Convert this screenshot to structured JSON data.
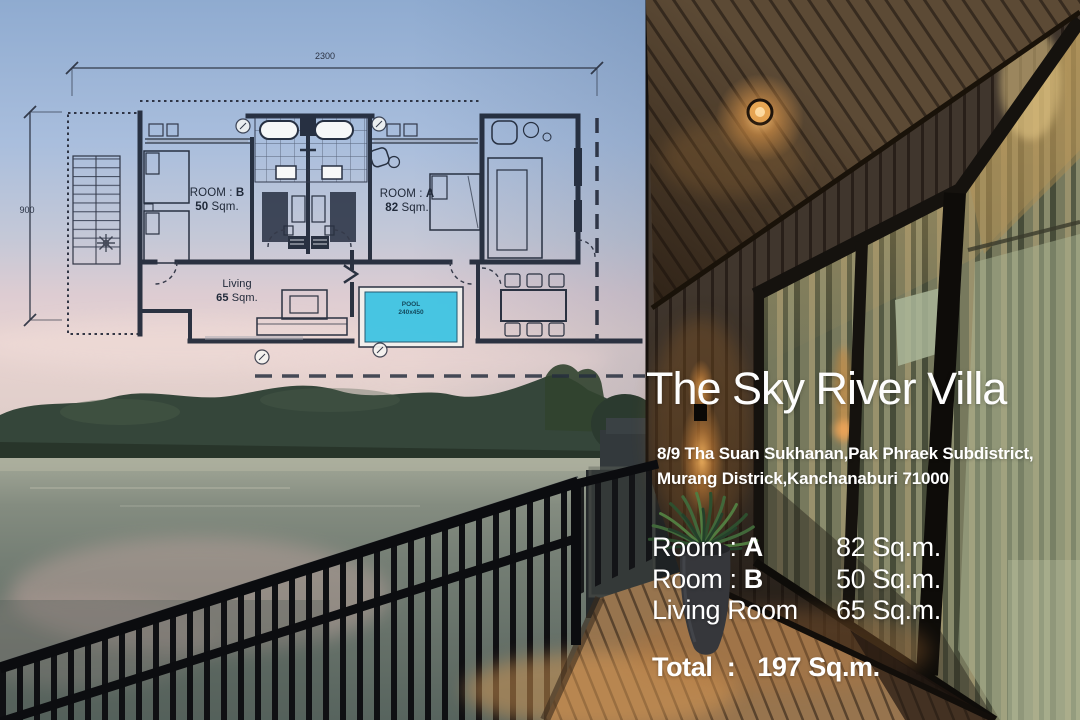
{
  "poster": {
    "title": "The Sky River Villa",
    "address_line1": "8/9 Tha Suan Sukhanan,Pak Phraek Subdistrict,",
    "address_line2": "Murang Districk,Kanchanaburi 71000",
    "area_rows": [
      {
        "label": "Room : ",
        "key": "A",
        "value": "82 Sq.m."
      },
      {
        "label": "Room : ",
        "key": "B",
        "value": "50 Sq.m."
      },
      {
        "label": "Living Room",
        "key": "",
        "value": "65 Sq.m."
      }
    ],
    "total_label": "Total  :",
    "total_value": "197 Sq.m."
  },
  "floorplan": {
    "dim_width": "2300",
    "dim_height": "900",
    "room_b": {
      "name": "ROOM : ",
      "key": "B",
      "area": "50",
      "unit": " Sqm."
    },
    "room_a": {
      "name": "ROOM : ",
      "key": "A",
      "area": "82",
      "unit": " Sqm."
    },
    "living": {
      "name": "Living",
      "area": "65",
      "unit": " Sqm."
    },
    "pool": {
      "name": "POOL",
      "size": "240x450"
    }
  },
  "colors": {
    "pool_water": "#3cc4e4",
    "plan_line": "#1e2636",
    "text": "#ffffff",
    "lamp_glow": "#f0a24e",
    "deck_wood": "#97744e"
  }
}
